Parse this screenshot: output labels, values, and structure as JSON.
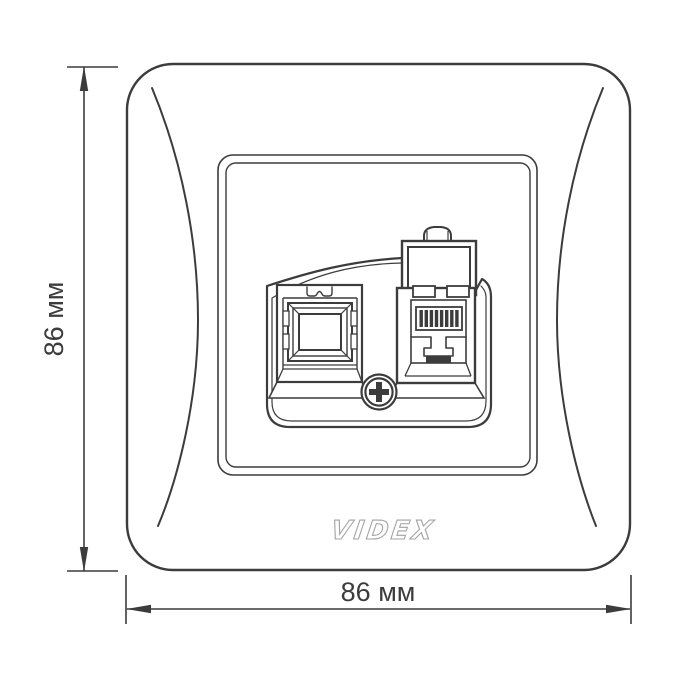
{
  "drawing": {
    "kind": "product dimension drawing",
    "dimensions": {
      "height_label": "86 мм",
      "width_label": "86 мм"
    },
    "brand": {
      "logo_text": "VIDEX"
    },
    "colors": {
      "line": "#3c3c3c",
      "logo_outline": "#a3a3a3",
      "background": "#ffffff"
    }
  }
}
